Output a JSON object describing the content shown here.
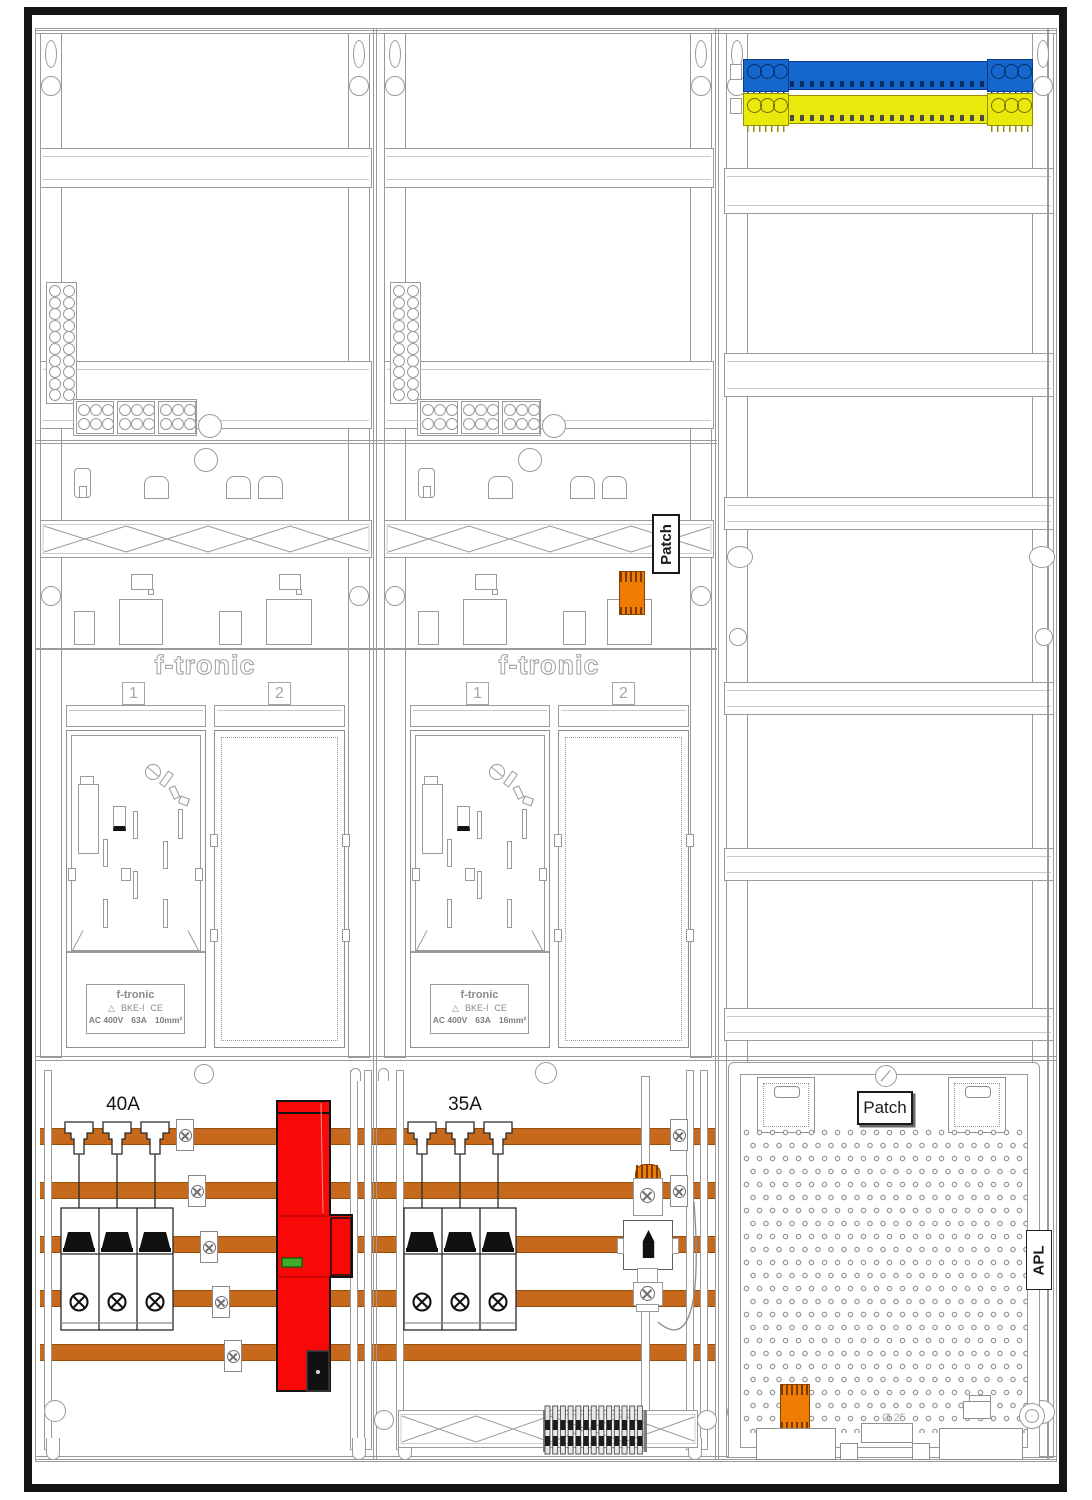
{
  "cabinet": {
    "field1": {
      "breaker_rating": "40A",
      "position1": "1",
      "position2": "2",
      "brand_logo": "f-tronic",
      "plate": {
        "brand": "f-tronic",
        "symbol": "△",
        "model": "BKE-I",
        "ce": "CE",
        "voltage": "AC 400V",
        "current": "63A",
        "cross_section": "10mm²"
      }
    },
    "field2": {
      "breaker_rating": "35A",
      "position1": "1",
      "position2": "2",
      "brand_logo": "f-tronic",
      "plate": {
        "brand": "f-tronic",
        "symbol": "△",
        "model": "BKE-I",
        "ce": "CE",
        "voltage": "AC 400V",
        "current": "63A",
        "cross_section": "16mm²"
      }
    },
    "multimedia": {
      "patch_label": "Patch",
      "panel_patch_label": "Patch",
      "apl_label": "APL",
      "conduit_diameter": "Ø 25"
    }
  },
  "colors": {
    "busbar": "#c7691c",
    "orange": "#ef7c04",
    "red": "#f90808",
    "green": "#3fae2a",
    "blue": "#1667cd",
    "yellow": "#e9e90c",
    "line": "#9a9a9a"
  }
}
